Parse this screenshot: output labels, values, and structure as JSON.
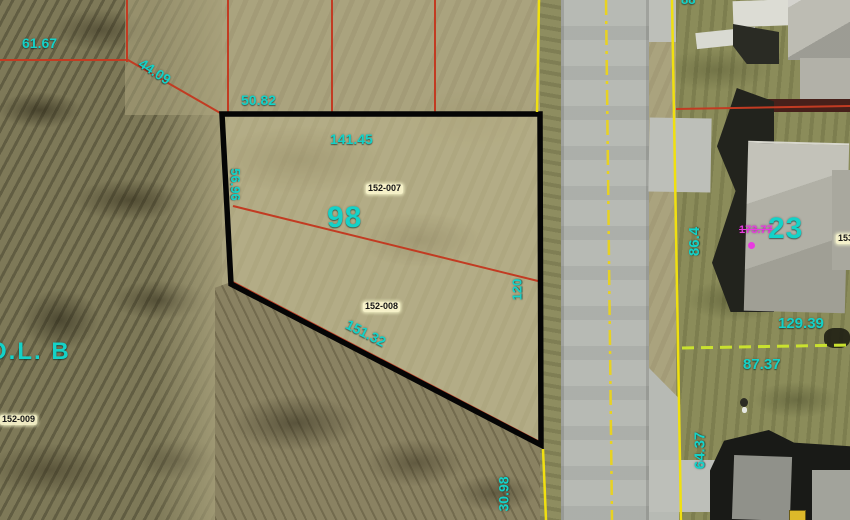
{
  "map": {
    "description": "aerial parcel map with survey overlay",
    "colors": {
      "measurement_text": "#14d2c8",
      "parcel_line_red": "#c23b22",
      "road_edge_yellow": "#f0e010",
      "boundary_dash_lime": "#c9e12f",
      "selected_parcel_outline": "#050505",
      "altered_value_magenta": "#e83ae0"
    },
    "labels": {
      "len_61_67": {
        "text": "61.67"
      },
      "len_44_09": {
        "text": "44.09"
      },
      "len_50_82": {
        "text": "50.82"
      },
      "len_141_45": {
        "text": "141.45"
      },
      "len_56_96": {
        "text": "56.96"
      },
      "lot_98": {
        "text": "98"
      },
      "pid_152_007": {
        "text": "152-007"
      },
      "pid_152_008": {
        "text": "152-008"
      },
      "len_151_32": {
        "text": "151.32"
      },
      "len_120": {
        "text": "120"
      },
      "len_30_98": {
        "text": "30.98"
      },
      "outlot_b": {
        "text": "O.L. B"
      },
      "pid_152_009": {
        "text": "152-009"
      },
      "len_86_4": {
        "text": "86.4"
      },
      "lot_23": {
        "text": "23"
      },
      "len_173_77": {
        "text": "173.77"
      },
      "len_129_39": {
        "text": "129.39"
      },
      "len_87_37": {
        "text": "87.37"
      },
      "len_64_37": {
        "text": "64.37"
      },
      "pid_153_partial": {
        "text": "153"
      },
      "len_top_partial": {
        "text": "88"
      }
    }
  }
}
